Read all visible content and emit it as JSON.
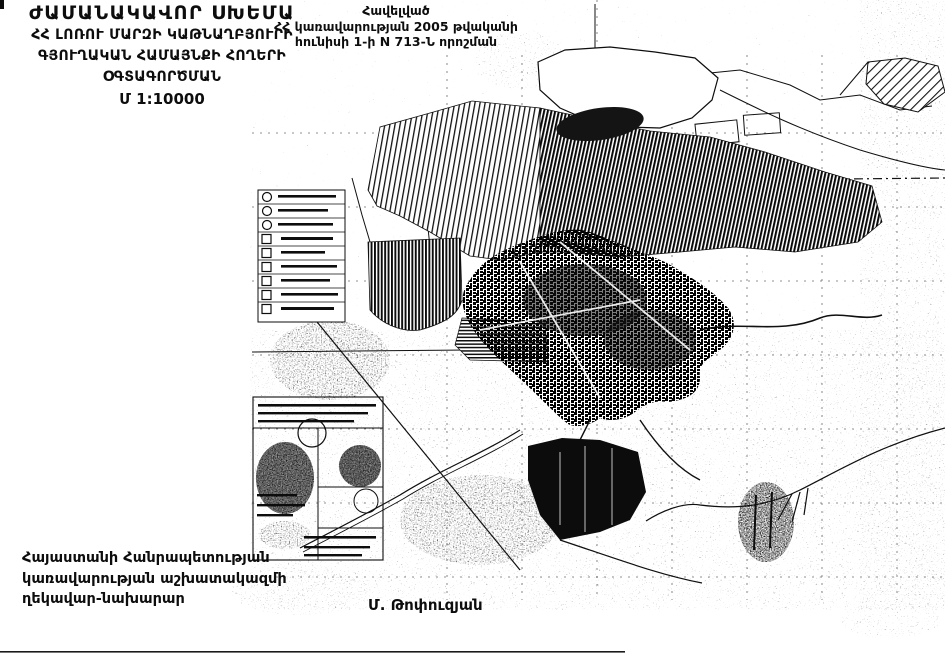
{
  "page": {
    "background": "#ffffff",
    "ink": "#0d0d0d"
  },
  "title_block": {
    "title": "ԺԱՄԱՆԱԿԱՎՈՐ ՍԽԵՄԱ",
    "line1": "ՀՀ ԼՈՌՈՒ ՄԱՐԶԻ ԿԱԹՆԱՂԲՅՈՒՐԻ",
    "line2": "ԳՅՈՒՂԱԿԱՆ ՀԱՄԱՅՆՔԻ ՀՈՂԵՐԻ",
    "line3": "ՕԳՏԱԳՈՐԾՄԱՆ",
    "scale": "Մ 1:10000"
  },
  "appendix_block": {
    "line1": "Հավելված",
    "line2": "ՀՀ կառավարության 2005 թվականի",
    "line3": "հունիսի 1-ի N 713-Ն որոշման"
  },
  "signature_block": {
    "line1": "Հայաստանի Հանրապետության",
    "line2": "կառավարության աշխատակազմի",
    "line3": "ղեկավար-նախարար",
    "signer_name": "Մ. Թոփուզյան"
  },
  "map": {
    "kind": "scanned black-and-white cadastral land-use map of Katnaghbyur rural community",
    "legend": {
      "rows": 9,
      "text_legible": false
    },
    "stamps_box": {
      "stamp_count": 2,
      "text_legible": false
    }
  }
}
